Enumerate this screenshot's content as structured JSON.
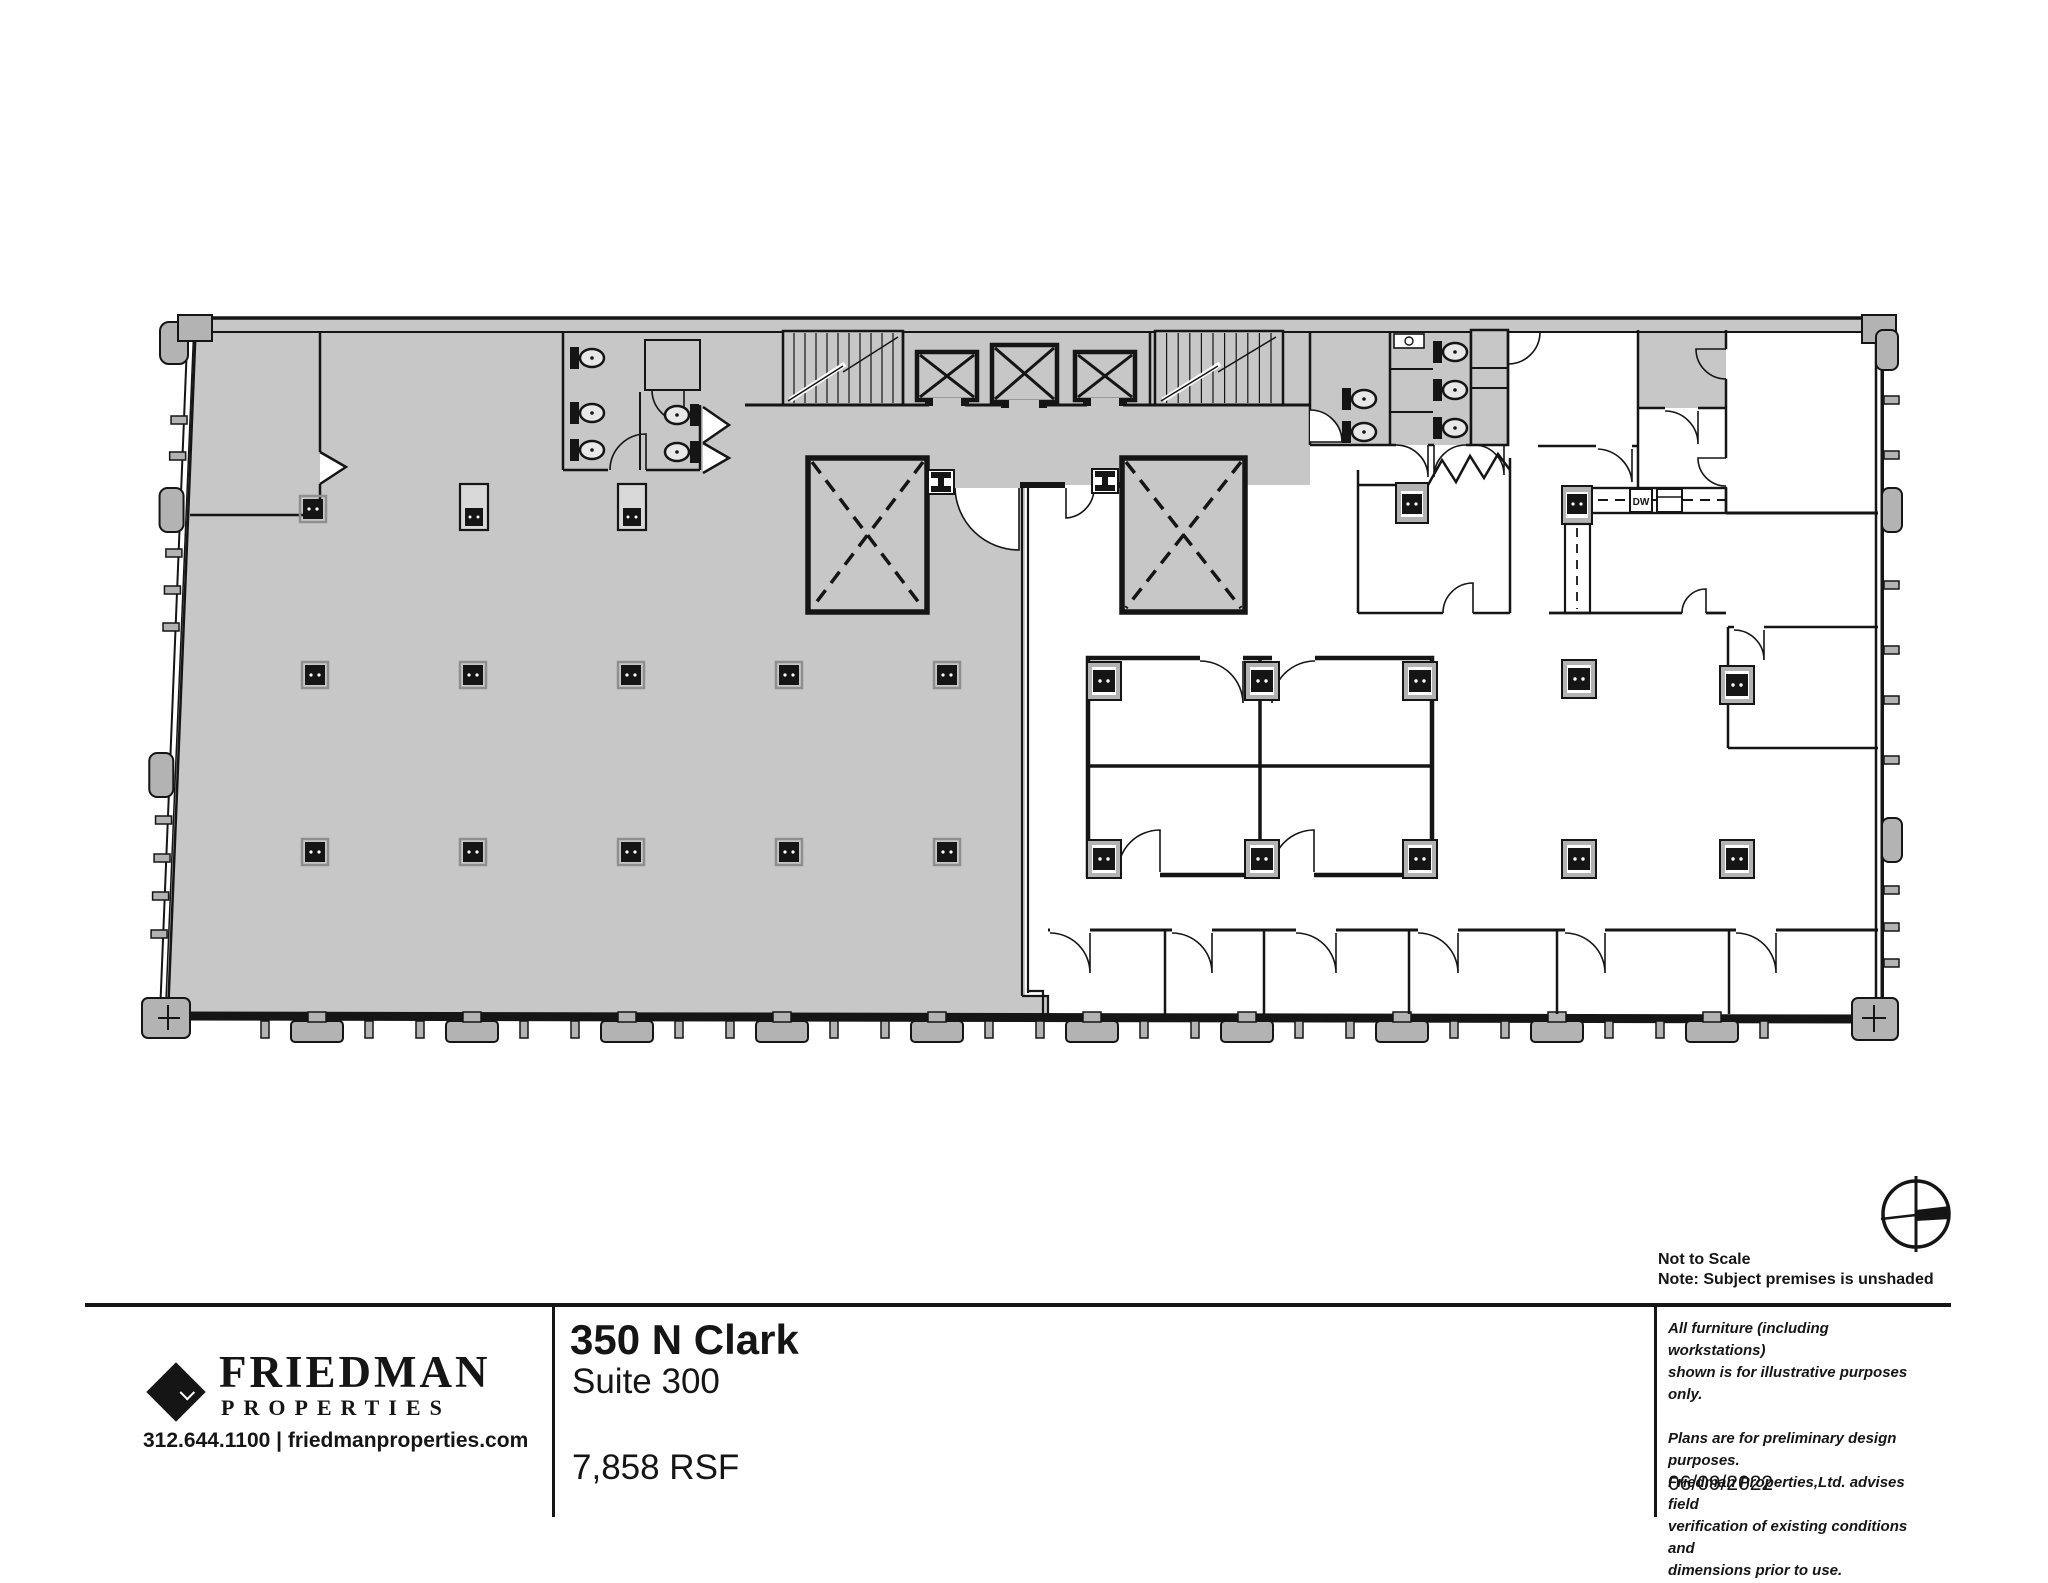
{
  "colors": {
    "paper": "#ffffff",
    "shaded_area": "#c7c7c7",
    "wall_line": "#151515",
    "mullion_gray": "#b3b3b3"
  },
  "floor_plan": {
    "dw_label": "DW",
    "shading_meaning": "Subject premises is unshaded"
  },
  "scale_note": {
    "line1": "Not to Scale",
    "line2": "Note: Subject premises is unshaded"
  },
  "title_block": {
    "logo": {
      "name": "FRIEDMAN",
      "sub": "PROPERTIES",
      "contact": "312.644.1100 | friedmanproperties.com"
    },
    "property": {
      "title": "350 N Clark",
      "subtitle": "Suite 300",
      "area": "7,858 RSF"
    },
    "notes": {
      "furniture_line1": "All furniture (including workstations)",
      "furniture_line2": "shown is for illustrative purposes only.",
      "disclaimer_line1": "Plans are for preliminary design purposes.",
      "disclaimer_line2": "Friedman Properties,Ltd. advises  field",
      "disclaimer_line3": "verification of existing conditions and",
      "disclaimer_line4": "dimensions prior to use.",
      "date": "06/09/2022"
    }
  }
}
